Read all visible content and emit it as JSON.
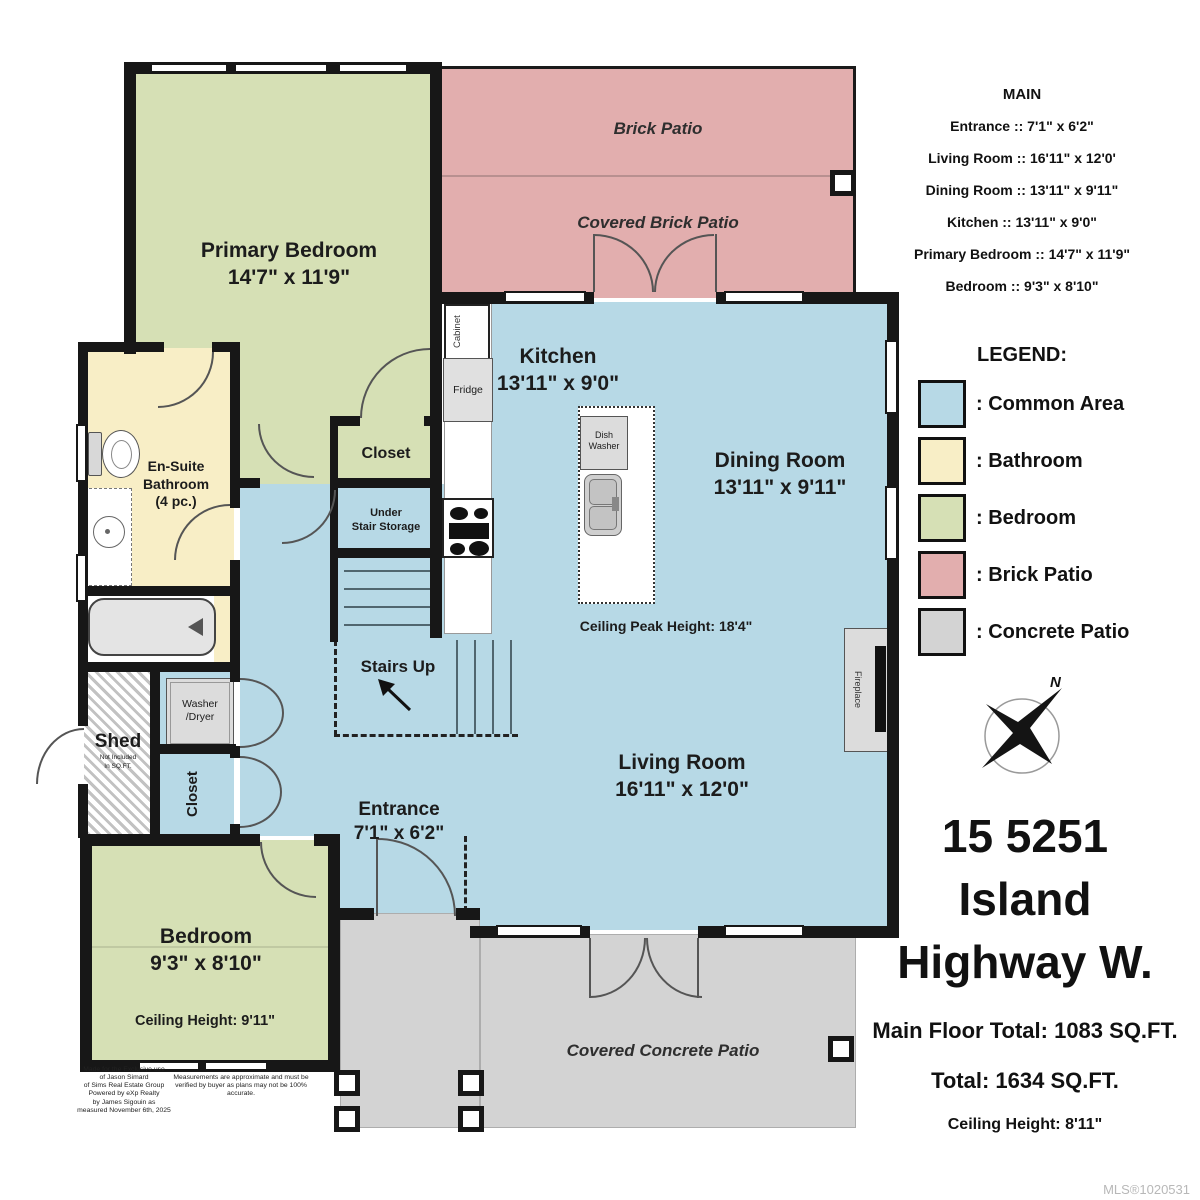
{
  "colors": {
    "common": "#b7d9e6",
    "bathroom": "#f8eec6",
    "bedroom": "#d6e0b5",
    "brick_patio": "#e2aeae",
    "concrete_patio": "#d3d3d3"
  },
  "summary": {
    "title": "MAIN",
    "items": [
      "Entrance :: 7'1\" x 6'2\"",
      "Living Room :: 16'11\" x 12'0'",
      "Dining Room :: 13'11\" x 9'11\"",
      "Kitchen :: 13'11\" x 9'0\"",
      "Primary Bedroom :: 14'7\" x 11'9\"",
      "Bedroom :: 9'3\" x 8'10\""
    ]
  },
  "legend": {
    "title": "LEGEND:",
    "items": [
      {
        "label": ": Common Area",
        "color": "#b7d9e6"
      },
      {
        "label": ": Bathroom",
        "color": "#f8eec6"
      },
      {
        "label": ": Bedroom",
        "color": "#d6e0b5"
      },
      {
        "label": ": Brick Patio",
        "color": "#e2aeae"
      },
      {
        "label": ": Concrete Patio",
        "color": "#d3d3d3"
      }
    ]
  },
  "compass": {
    "north": "N"
  },
  "listing": {
    "address1": "15 5251",
    "address2": "Island",
    "address3": "Highway W.",
    "main_floor_total": "Main Floor Total: 1083 SQ.FT.",
    "total": "Total: 1634 SQ.FT.",
    "ceiling_height": "Ceiling Height: 8'11\"",
    "mls": "MLS®1020531"
  },
  "rooms": {
    "primary_bedroom": {
      "name": "Primary Bedroom",
      "dims": "14'7\" x 11'9\""
    },
    "kitchen": {
      "name": "Kitchen",
      "dims": "13'11\" x 9'0\""
    },
    "dining_room": {
      "name": "Dining Room",
      "dims": "13'11\" x 9'11\""
    },
    "living_room": {
      "name": "Living Room",
      "dims": "16'11\" x 12'0\""
    },
    "entrance": {
      "name": "Entrance",
      "dims": "7'1\" x 6'2\""
    },
    "bedroom": {
      "name": "Bedroom",
      "dims": "9'3\" x 8'10\"",
      "ceiling": "Ceiling Height: 9'11\""
    },
    "ensuite": {
      "line1": "En-Suite",
      "line2": "Bathroom",
      "line3": "(4 pc.)"
    },
    "closet_primary": "Closet",
    "closet_hall": "Closet",
    "under_stair": {
      "line1": "Under",
      "line2": "Stair Storage"
    },
    "stairs_up": "Stairs Up",
    "shed": {
      "name": "Shed",
      "note1": "Not Included",
      "note2": "In SQ.FT."
    },
    "ceiling_peak": "Ceiling Peak Height: 18'4\"",
    "brick_patio": "Brick Patio",
    "covered_brick_patio": "Covered Brick Patio",
    "covered_concrete_patio": "Covered Concrete Patio"
  },
  "fixtures": {
    "cabinet": "Cabinet",
    "fridge": "Fridge",
    "dishwasher_line1": "Dish",
    "dishwasher_line2": "Washer",
    "washer_line1": "Washer",
    "washer_line2": "/Dryer",
    "fireplace": "Fireplace"
  },
  "disclaimer": {
    "left": [
      "Made for the Exclusive use",
      "of Jason Simard",
      "of Sims Real Estate Group",
      "Powered by eXp Realty",
      "by James Sigouin as",
      "measured November 6th, 2025"
    ],
    "right": [
      "Measurements are approximate and must be",
      "verified by buyer as plans may not be 100% accurate."
    ]
  }
}
